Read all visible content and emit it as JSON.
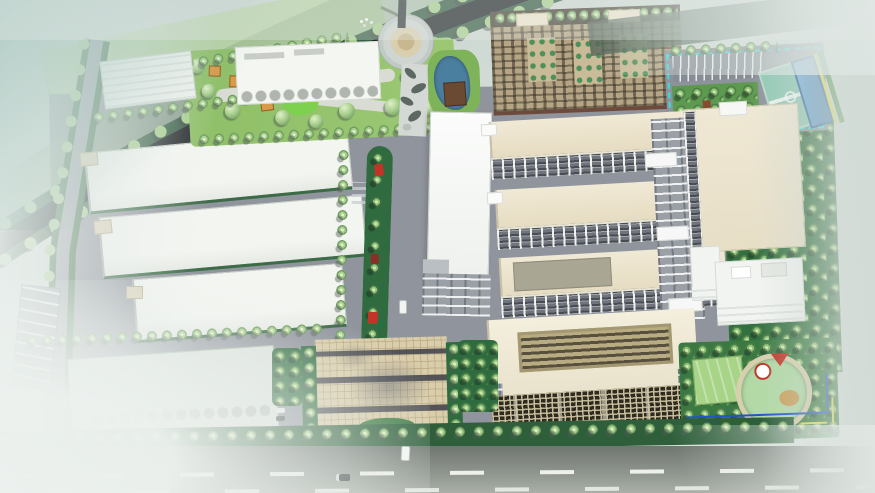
{
  "scene": {
    "type": "aerial-architectural-rendering",
    "subject": "industrial-park-master-plan"
  },
  "palette": {
    "mist": "#dfe7e3",
    "haze_teal": "#8fb5ab",
    "haze_right": "#c3cdc6",
    "highway_asphalt": "#24282b",
    "highway_verge": "#3a5f46",
    "highway_grass": "#8fae85",
    "road": "#8d929b",
    "road_light": "#9aa0a6",
    "green_dark": "#2e6b3f",
    "green_belt": "#2e5f3a",
    "lawn": "#8fbf68",
    "lawn_pale": "#b6d2a0",
    "tree_light": "#dff0c8",
    "tree_mid": "#a9cf8e",
    "tree_dark": "#6e9c60",
    "warehouse_white": "#f3f5f1",
    "warehouse_edge": "#3c6b47",
    "factory_cream": "#ece4cd",
    "factory_facade": "#70757d",
    "dorm_wall": "#b5a584",
    "dorm_roof": "#efe7cf",
    "dorm_frame": "#4a4438",
    "dorm_base": "#6e4a3c",
    "court_teal": "#8fc8b4",
    "pool_blue": "#4f92c6",
    "rec_cyan": "#35e0dc",
    "plaza_tile": "#d9cdaa",
    "plaza_band": "#43454f",
    "sign_teal": "#2e7f96",
    "sign_frame": "#173a40",
    "median_green": "#2f6b3f",
    "sculpture_red": "#c03528",
    "pond_blue": "#4a7fa0",
    "pond_water": "#b2d9a6",
    "pond_deck": "#d8cfae",
    "accent_yellow": "#e8e23c",
    "accent_blue": "#2255cc",
    "asphalt": "#6f756f",
    "lane_dash": "#f2f5f0",
    "orchard": "#33703f"
  }
}
